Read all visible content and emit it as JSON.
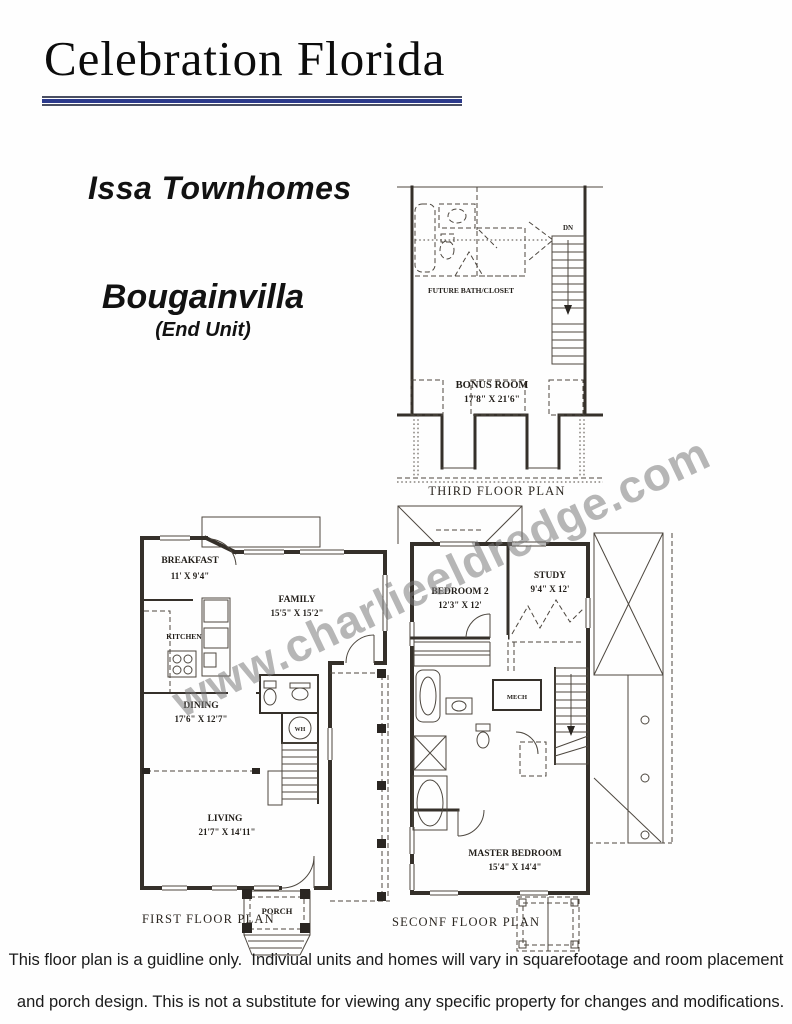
{
  "header": {
    "title": "Celebration Florida",
    "community": "Issa Townhomes",
    "model": "Bougainvilla",
    "model_note": "(End Unit)"
  },
  "colors": {
    "accent_navy": "#2c3a8c",
    "plan_ink": "#35302a",
    "watermark_gray": "#7a7a7a"
  },
  "watermark": "www.charlieeldredge.com",
  "floors": {
    "third": {
      "caption": "THIRD FLOOR PLAN",
      "rooms": {
        "bonus": {
          "name": "BONUS ROOM",
          "dims": "17'8\" X 21'6\""
        },
        "future_bath": {
          "name": "FUTURE BATH/CLOSET"
        },
        "stairs": {
          "name": "DN"
        }
      }
    },
    "first": {
      "caption": "FIRST FLOOR PLAN",
      "rooms": {
        "breakfast": {
          "name": "BREAKFAST",
          "dims": "11' X 9'4\""
        },
        "kitchen": {
          "name": "KITCHEN"
        },
        "family": {
          "name": "FAMILY",
          "dims": "15'5\" X 15'2\""
        },
        "dining": {
          "name": "DINING",
          "dims": "17'6\" X 12'7\""
        },
        "living": {
          "name": "LIVING",
          "dims": "21'7\" X 14'11\""
        },
        "water_heater": {
          "name": "WH"
        },
        "porch": {
          "name": "PORCH"
        }
      }
    },
    "second": {
      "caption": "SECONF FLOOR PLAN",
      "rooms": {
        "bedroom2": {
          "name": "BEDROOM 2",
          "dims": "12'3\" X 12'"
        },
        "study": {
          "name": "STUDY",
          "dims": "9'4\" X 12'"
        },
        "mech": {
          "name": "MECH"
        },
        "master": {
          "name": "MASTER BEDROOM",
          "dims": "15'4\" X 14'4\""
        }
      }
    }
  },
  "disclaimer": {
    "line1": "This floor plan is a guidline only.  Indiviual units and homes will vary in squarefootage and room placement",
    "line2": "and porch design. This is not a substitute for viewing any specific property for changes and modifications."
  }
}
